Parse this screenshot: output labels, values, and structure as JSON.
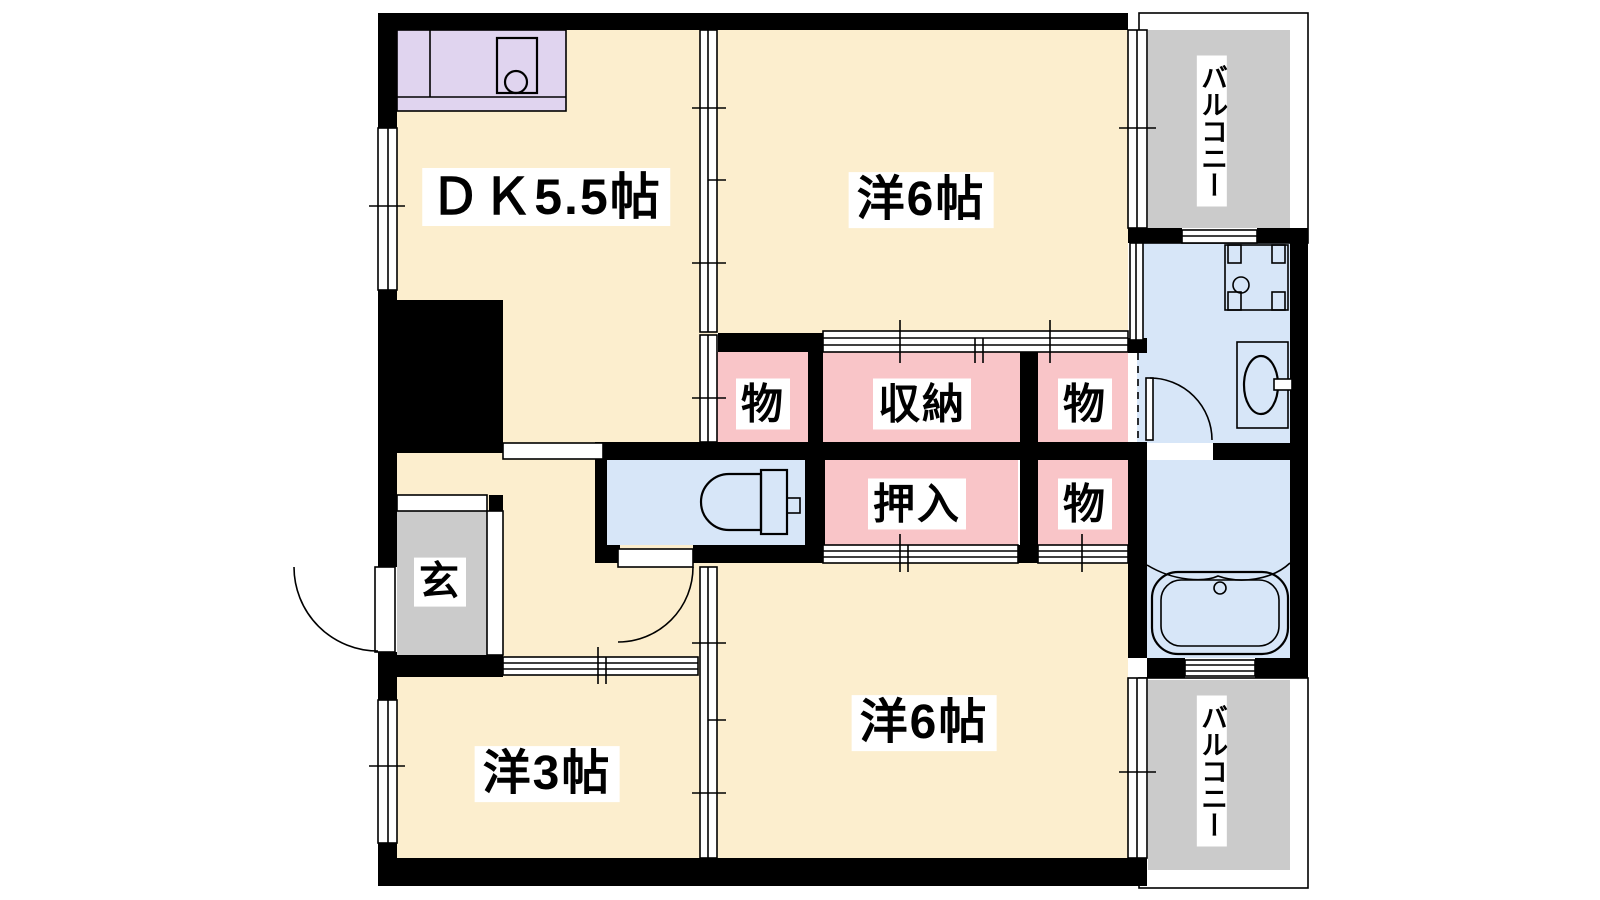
{
  "palette": {
    "room": "#FCEECE",
    "storage": "#F9C5C8",
    "water": "#D7E6F8",
    "kitchen": "#E0D4EF",
    "balcony": "#CBCBCB",
    "wall": "#000000",
    "label_text": "#000000",
    "label_bg": "#FFFFFF"
  },
  "rooms": [
    {
      "id": "dk",
      "label": "ＤＫ5.5帖"
    },
    {
      "id": "western6-top",
      "label": "洋6帖"
    },
    {
      "id": "western6-bottom",
      "label": "洋6帖"
    },
    {
      "id": "western3",
      "label": "洋3帖"
    },
    {
      "id": "genkan",
      "label": "玄"
    },
    {
      "id": "closet-top-left",
      "label": "物"
    },
    {
      "id": "storage-main",
      "label": "収納"
    },
    {
      "id": "closet-top-right",
      "label": "物"
    },
    {
      "id": "oshiire",
      "label": "押入"
    },
    {
      "id": "closet-bottom-right",
      "label": "物"
    },
    {
      "id": "balcony-top",
      "label": "バルコニー"
    },
    {
      "id": "balcony-bottom",
      "label": "バルコニー"
    }
  ]
}
